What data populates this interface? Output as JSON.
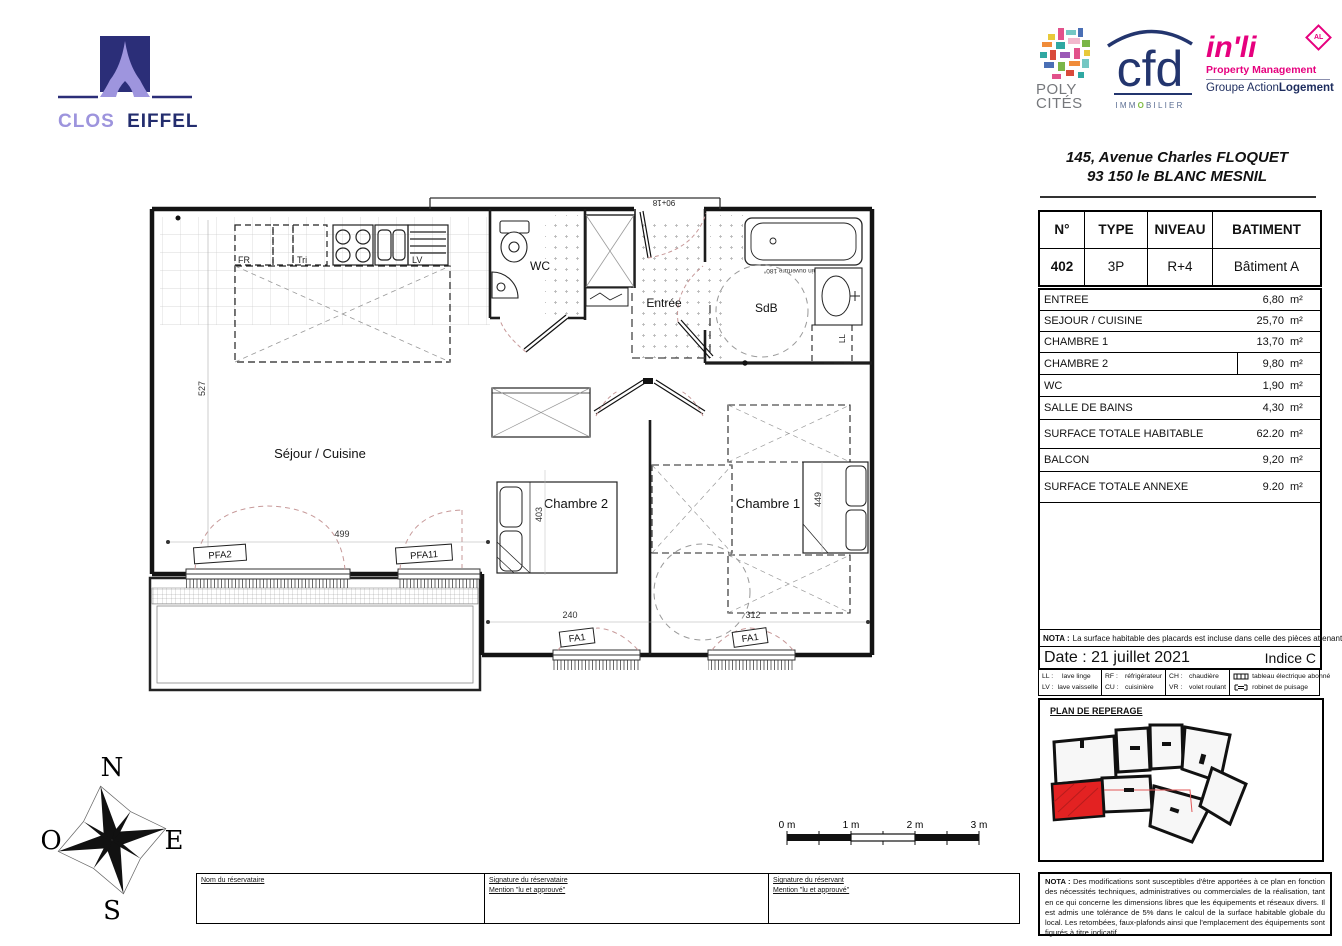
{
  "branding": {
    "clos": "CLOS",
    "eiffel": "EIFFEL",
    "poly": "POLY",
    "cites": "CITÉS",
    "cfd": "cfd",
    "immobilier_left": "IMM",
    "immobilier_o": "O",
    "immobilier_right": "BILIER",
    "inli": "in'li",
    "inli_badge": "AL",
    "property_mgmt": "Property Management",
    "groupe_prefix": "Groupe Action",
    "groupe_bold": "Logement"
  },
  "address": {
    "line1": "145, Avenue Charles FLOQUET",
    "line2": "93 150 le BLANC MESNIL"
  },
  "unit_table": {
    "headers": [
      "N°",
      "TYPE",
      "NIVEAU",
      "BATIMENT"
    ],
    "row": [
      "402",
      "3P",
      "R+4",
      "Bâtiment A"
    ]
  },
  "areas": {
    "rows": [
      {
        "label": "ENTREE",
        "value": "6,80",
        "unit": "m²"
      },
      {
        "label": "SEJOUR / CUISINE",
        "value": "25,70",
        "unit": "m²"
      },
      {
        "label": "CHAMBRE 1",
        "value": "13,70",
        "unit": "m²"
      },
      {
        "label": "CHAMBRE 2",
        "value": "9,80",
        "unit": "m²"
      },
      {
        "label": "WC",
        "value": "1,90",
        "unit": "m²"
      },
      {
        "label": "SALLE DE BAINS",
        "value": "4,30",
        "unit": "m²"
      },
      {
        "label": "SURFACE TOTALE HABITABLE",
        "value": "62.20",
        "unit": "m²"
      },
      {
        "label": "BALCON",
        "value": "9,20",
        "unit": "m²"
      },
      {
        "label": "SURFACE TOTALE ANNEXE",
        "value": "9.20",
        "unit": "m²"
      }
    ]
  },
  "nota1": {
    "prefix": "NOTA :",
    "text": "La surface habitable des placards est incluse dans celle des pièces attenantes"
  },
  "date_line": {
    "date": "Date : 21 juillet 2021",
    "indice": "Indice C"
  },
  "legend": {
    "items": [
      {
        "abbr": "LL :",
        "label": "lave linge"
      },
      {
        "abbr": "LV :",
        "label": "lave vaisselle"
      },
      {
        "abbr": "RF :",
        "label": "réfrigérateur"
      },
      {
        "abbr": "CU :",
        "label": "cuisinière"
      },
      {
        "abbr": "CH :",
        "label": "chaudière"
      },
      {
        "abbr": "VR :",
        "label": "volet roulant"
      },
      {
        "symbol": "tableau-electrique",
        "label": "tableau électrique abonné"
      },
      {
        "symbol": "robinet-puisage",
        "label": "robinet de puisage"
      }
    ]
  },
  "reperage": {
    "title": "PLAN DE REPERAGE",
    "highlight_color": "#e32222"
  },
  "nota2": {
    "prefix": "NOTA :",
    "text": "Des modifications sont susceptibles d'être apportées à ce plan en fonction des nécessités techniques, administratives ou commerciales de la réalisation, tant en ce qui concerne les dimensions libres que les équipements et réseaux divers. Il est admis une tolérance de 5% dans le calcul de la surface habitable globale du local. Les retombées, faux-plafonds ainsi que l'emplacement des équipements sont figurés à titre indicatif."
  },
  "plan": {
    "rooms": {
      "sejour": "Séjour / Cuisine",
      "chambre1": "Chambre 1",
      "chambre2": "Chambre 2",
      "wc": "WC",
      "entree": "Entrée",
      "sdb": "SdB"
    },
    "appliances": {
      "fr": "FR",
      "tri": "Tri",
      "lv": "LV",
      "ll": "LL"
    },
    "dims": {
      "d527": "527",
      "d499": "499",
      "d403": "403",
      "d240": "240",
      "d312": "312",
      "d449": "449",
      "door": "90+18"
    },
    "windows": {
      "pfa2": "PFA2",
      "pfa11": "PFA11",
      "fa1a": "FA1",
      "fa1b": "FA1"
    },
    "bath_note": "Pare-bain ouverture 180°"
  },
  "compass": {
    "n": "N",
    "s": "S",
    "e": "E",
    "o": "O"
  },
  "scalebar": {
    "labels": [
      "0 m",
      "1 m",
      "2 m",
      "3 m"
    ]
  },
  "signature": {
    "cell1": "Nom du réservataire",
    "cell2a": "Signature du réservataire",
    "cell2b": "Mention \"lu et approuvé\"",
    "cell3a": "Signature du réservant",
    "cell3b": "Mention \"lu et approuvé\""
  }
}
